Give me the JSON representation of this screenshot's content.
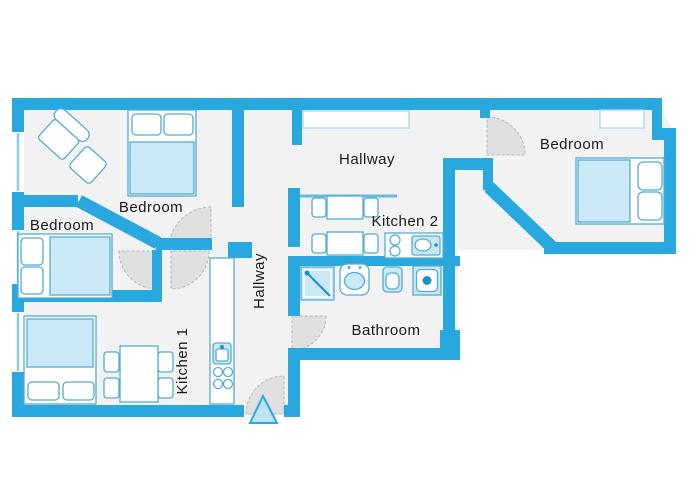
{
  "title": "Apartment floor plan",
  "rooms": {
    "bedroom_top_left": {
      "label": "Bedroom"
    },
    "bedroom_left": {
      "label": "Bedroom"
    },
    "bedroom_right": {
      "label": "Bedroom"
    },
    "hallway_top": {
      "label": "Hallway"
    },
    "hallway_main": {
      "label": "Hallway"
    },
    "kitchen_1": {
      "label": "Kitchen 1"
    },
    "kitchen_2": {
      "label": "Kitchen 2"
    },
    "bathroom": {
      "label": "Bathroom"
    }
  },
  "entrance": {
    "marker_icon": "entrance-arrow"
  },
  "furniture_icons": [
    "double-bed-icon",
    "pillow-icon",
    "armchair-icon",
    "ottoman-icon",
    "dining-table-icon",
    "chair-icon",
    "kitchen-counter-icon",
    "stove-burners-icon",
    "kitchen-sink-icon",
    "shower-icon",
    "washbasin-icon",
    "toilet-icon",
    "washing-machine-icon",
    "wardrobe-icon",
    "shelf-icon",
    "door-swing-icon",
    "window-icon"
  ],
  "colors": {
    "wall": "#29A8E0",
    "floor": "#F2F2F2",
    "furniture_fill": "#FFFFFF",
    "furniture_outline": "#54ACD2",
    "soft_fill": "#CBE8F7",
    "door_swing": "#E0E0E0",
    "accent": "#1E8FC4",
    "text": "#1A1A1A"
  }
}
